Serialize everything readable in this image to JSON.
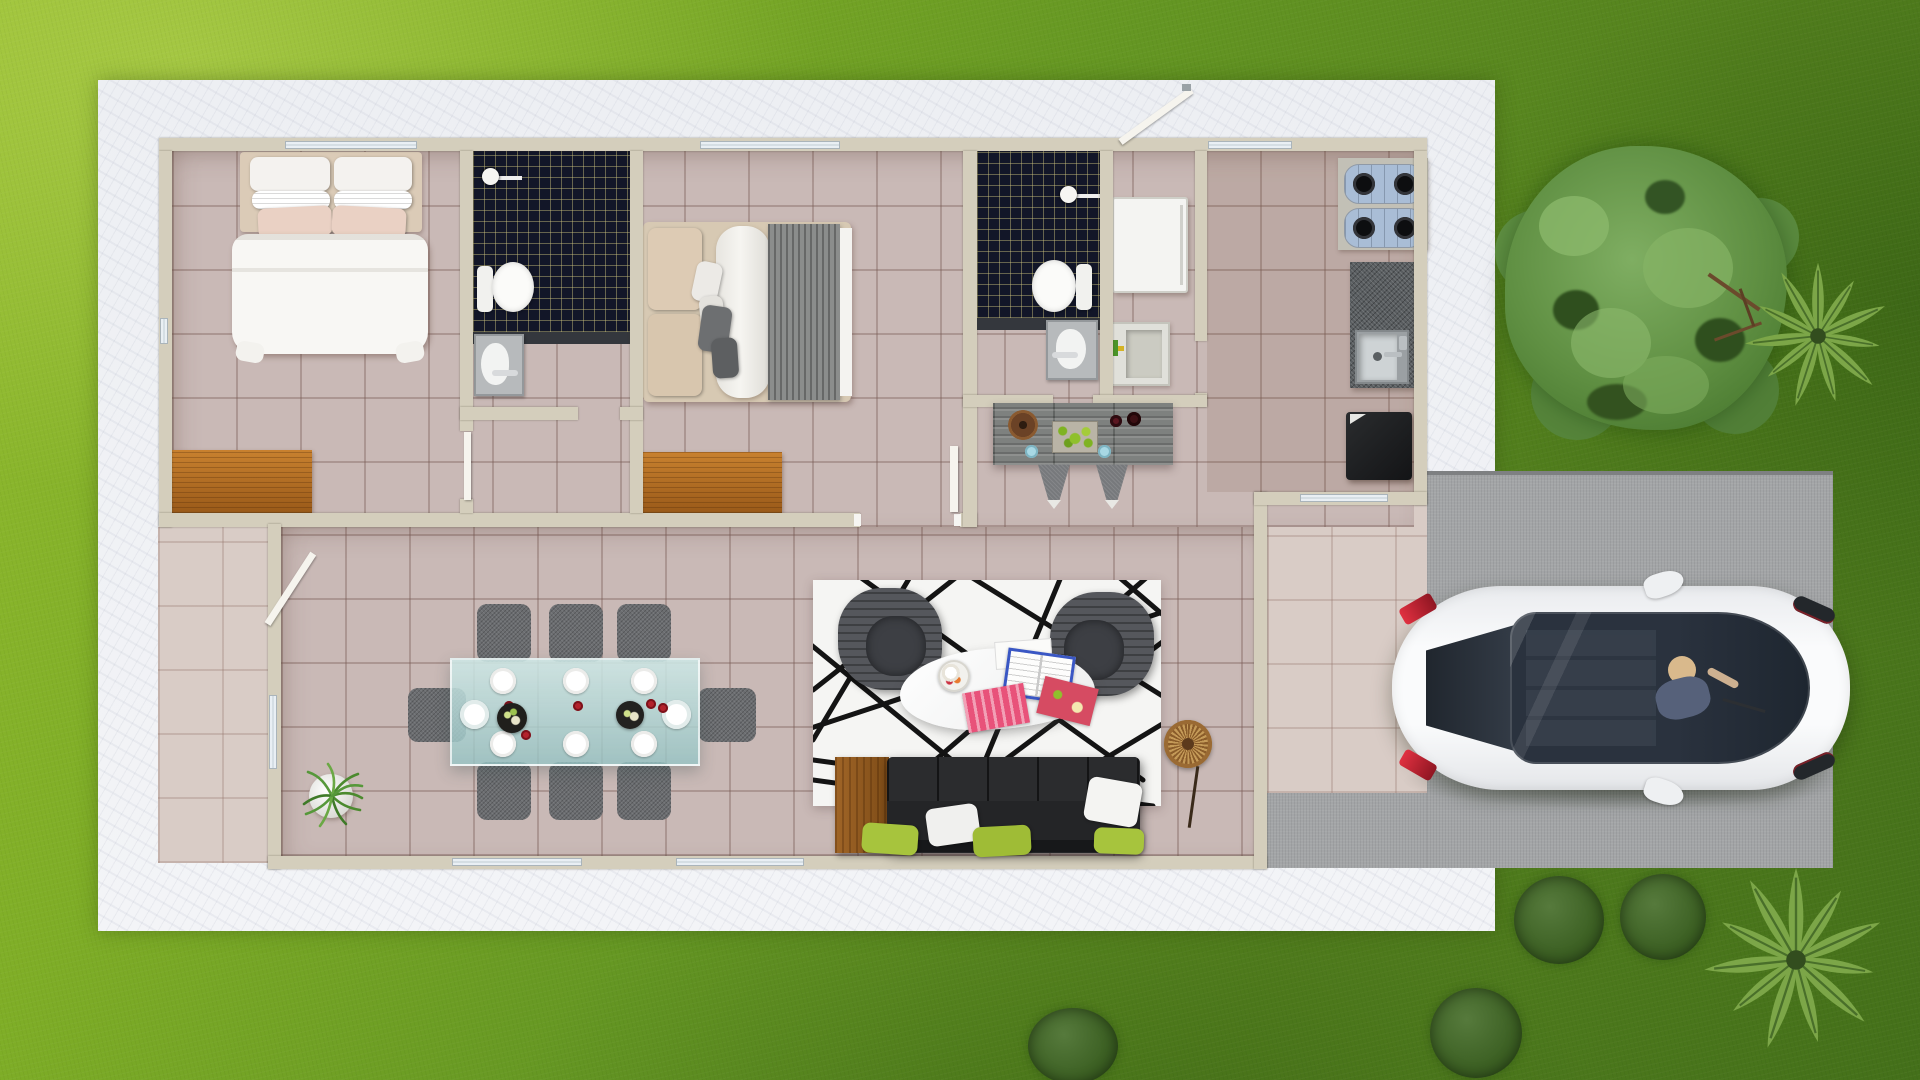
{
  "scene": {
    "type": "3d-floor-plan-render",
    "view": "top-down aerial",
    "setting": "single-story house on lawn with concrete pad, side driveway and parked car",
    "visible_text": "none"
  },
  "palette": {
    "grass_light": "#93bc30",
    "grass_dark": "#44701a",
    "pad": "#f0f2f5",
    "driveway": "#a3a5a7",
    "floor_tile": "#c9b9b6",
    "patio_tile": "#d9ccc6",
    "wall": "#d4cebc",
    "shower_tile": "#121628",
    "shower_grout_gold": "#cdc37d",
    "wood_dresser": "#b06a20",
    "glass_table": "#a8d0d0",
    "chair_gray": "#6b6d70",
    "sofa_black": "#242527",
    "pillow_green": "#a7c43d",
    "rug_white": "#f5f5f3",
    "rug_lines": "#141414",
    "car_body": "#f4f5f6",
    "car_glass": "#2a323e",
    "tail_light": "#c22233",
    "tree_canopy": "#5f8f42",
    "bush": "#3c6023"
  },
  "house": {
    "rooms": [
      {
        "id": "bedroom-1",
        "furniture": [
          "double-bed-white-linen",
          "pillows-white-x4",
          "pillows-peach-x2",
          "wood-dresser"
        ]
      },
      {
        "id": "ensuite-bathroom-1",
        "furniture": [
          "black-tile-shower",
          "shower-head",
          "toilet",
          "pedestal-sink"
        ]
      },
      {
        "id": "bedroom-2",
        "furniture": [
          "double-bed-gray-throw",
          "pillows-beige",
          "pillows-gray",
          "wood-dresser"
        ]
      },
      {
        "id": "bathroom-2",
        "furniture": [
          "black-tile-shower",
          "shower-head",
          "toilet",
          "pedestal-sink"
        ]
      },
      {
        "id": "laundry-room",
        "furniture": [
          "washing-machine",
          "laundry-tub-with-faucet"
        ]
      },
      {
        "id": "kitchen",
        "furniture": [
          "cooktop-two-modules-4-burners",
          "granite-counter",
          "stainless-sink",
          "black-refrigerator"
        ]
      },
      {
        "id": "dining-area",
        "furniture": [
          "glass-dining-table",
          "gray-chairs-x8",
          "white-plates-x8",
          "red-cups-x5",
          "serving-trays-x2"
        ]
      },
      {
        "id": "living-room",
        "furniture": [
          "black-white-geometric-rug",
          "gray-armchairs-x2",
          "white-organic-coffee-table",
          "magazines-x3",
          "black-sofa",
          "wood-side-table",
          "sofa-pillows-white-x2",
          "sofa-pillows-green-x3",
          "rattan-wall-decor",
          "potted-grass-plant"
        ]
      },
      {
        "id": "breakfast-bar",
        "furniture": [
          "granite-bar-counter",
          "bar-stools-x2",
          "fruit-tray-green-apples",
          "ring-bowl-wood",
          "bottles-x2",
          "blue-cups-x2"
        ]
      }
    ],
    "open_doors": [
      "side-entrance-door",
      "back-entrance-door",
      "bedroom-2-door",
      "ensuite-door"
    ],
    "windows": [
      "top-wall-x3",
      "bottom-wall-x2",
      "left-wall-x2",
      "kitchen-slider-x1"
    ]
  },
  "exterior": {
    "driveway": "gray concrete, right side",
    "car": {
      "type": "hatchback",
      "color": "white",
      "orientation": "front facing right",
      "details": [
        "panoramic-glass-roof",
        "driver-visible",
        "red-taillights",
        "side-mirrors"
      ]
    },
    "vegetation": [
      "large-round-tree-top-right",
      "palm-tree-upper-right",
      "palm-tree-lower-right",
      "bush-x2-below-driveway",
      "bush-bottom-left-of-palm",
      "bush-bottom-center"
    ]
  }
}
